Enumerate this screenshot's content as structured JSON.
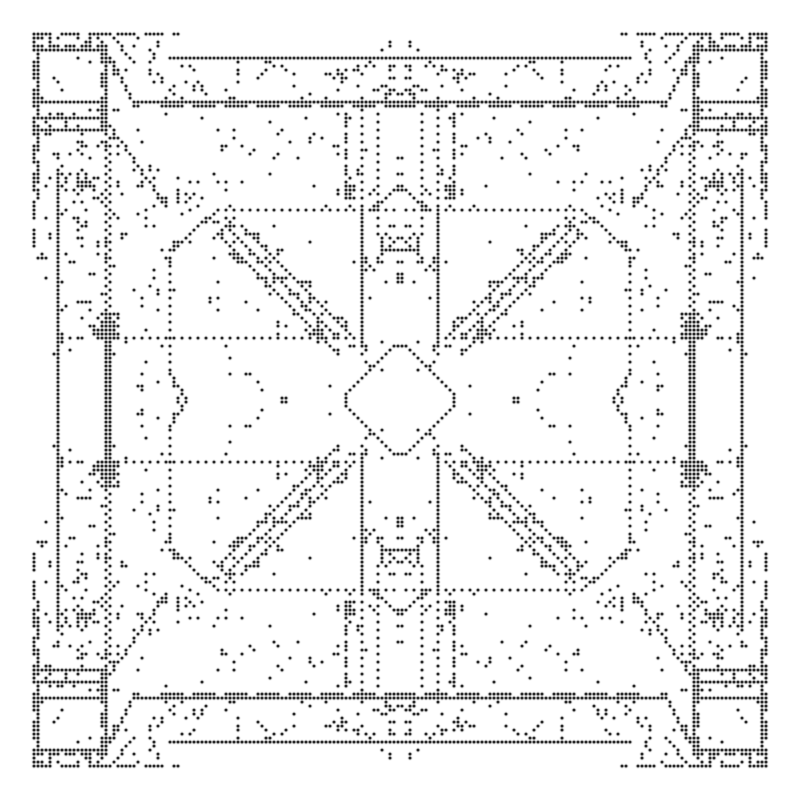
{
  "pattern": {
    "description": "Symmetric black dot-matrix ornamental pattern on white background",
    "canvas_size": 800,
    "grid": 200,
    "pitch": 4,
    "dot_radius": 1.55,
    "dot_color": "#000000",
    "background_color": "#ffffff",
    "symmetry": "mirror-horizontal-and-vertical",
    "seed": 1337,
    "quadrant_features": [
      {
        "type": "hline",
        "y": 8,
        "x0": 8,
        "x1": 44,
        "dash": [
          5,
          2
        ]
      },
      {
        "type": "vline",
        "x": 8,
        "y0": 8,
        "y1": 62,
        "dash": [
          5,
          2
        ]
      },
      {
        "type": "hline",
        "y": 11,
        "x0": 8,
        "x1": 26,
        "dash": [
          3,
          1
        ]
      },
      {
        "type": "cluster",
        "x0": 9,
        "y0": 9,
        "x1": 25,
        "y1": 10,
        "density": 0.4,
        "patch": 0.8
      },
      {
        "type": "hline",
        "y": 12,
        "x0": 9,
        "x1": 26,
        "dash": [
          1,
          0
        ]
      },
      {
        "type": "vline",
        "x": 9,
        "y0": 12,
        "y1": 29,
        "dash": [
          1,
          0
        ]
      },
      {
        "type": "vline",
        "x": 25,
        "y0": 12,
        "y1": 32,
        "dash": [
          4,
          2
        ]
      },
      {
        "type": "vline",
        "x": 26,
        "y0": 12,
        "y1": 32,
        "dash": [
          1,
          0
        ]
      },
      {
        "type": "hline",
        "y": 29,
        "x0": 8,
        "x1": 26,
        "dash": [
          1,
          0
        ]
      },
      {
        "type": "hline",
        "y": 25,
        "x0": 9,
        "x1": 25,
        "dash": [
          1,
          0
        ]
      },
      {
        "type": "hline",
        "y": 32,
        "x0": 8,
        "x1": 26,
        "dash": [
          1,
          0
        ]
      },
      {
        "type": "cluster",
        "x0": 10,
        "y0": 13,
        "x1": 24,
        "y1": 24,
        "density": 0.07,
        "patch": 0.6
      },
      {
        "type": "cluster",
        "x0": 9,
        "y0": 26,
        "x1": 25,
        "y1": 31,
        "density": 0.22,
        "patch": 0.7
      },
      {
        "type": "vline",
        "x": 9,
        "y0": 33,
        "y1": 49,
        "dash": [
          5,
          2
        ]
      },
      {
        "type": "cluster",
        "x0": 9,
        "y0": 33,
        "x1": 30,
        "y1": 48,
        "density": 0.17,
        "patch": 0.5
      },
      {
        "type": "cluster",
        "x0": 28,
        "y0": 9,
        "x1": 40,
        "y1": 27,
        "density": 0.15,
        "patch": 0.5
      },
      {
        "type": "line",
        "x0": 27,
        "y0": 8,
        "x1": 33,
        "y1": 15
      },
      {
        "type": "line",
        "x0": 24,
        "y0": 9,
        "x1": 33,
        "y1": 25
      },
      {
        "type": "hline",
        "y": 14,
        "x0": 42,
        "x1": 99,
        "dash": [
          1,
          0
        ]
      },
      {
        "type": "hline",
        "y": 25,
        "x0": 33,
        "x1": 99,
        "dash": [
          1,
          0
        ]
      },
      {
        "type": "hline",
        "y": 26,
        "x0": 40,
        "x1": 99,
        "dash": [
          6,
          2
        ]
      },
      {
        "type": "cluster",
        "x0": 33,
        "y0": 15,
        "x1": 99,
        "y1": 24,
        "density": 0.22,
        "patch": 0.45
      },
      {
        "type": "vline",
        "x": 86,
        "y0": 29,
        "y1": 46,
        "dash": [
          3,
          1
        ]
      },
      {
        "type": "cluster",
        "x0": 84,
        "y0": 46,
        "x1": 88,
        "y1": 49,
        "density": 0.5,
        "patch": 1
      },
      {
        "type": "cluster",
        "x0": 78,
        "y0": 28,
        "x1": 99,
        "y1": 51,
        "density": 0.15,
        "patch": 0.45
      },
      {
        "type": "cluster",
        "x0": 52,
        "y0": 28,
        "x1": 78,
        "y1": 45,
        "density": 0.12,
        "patch": 0.4
      },
      {
        "type": "vline",
        "x": 14,
        "y0": 42,
        "y1": 99,
        "dash": [
          1,
          0
        ]
      },
      {
        "type": "vline",
        "x": 26,
        "y0": 33,
        "y1": 78,
        "dash": [
          1,
          1
        ]
      },
      {
        "type": "vline",
        "x": 27,
        "y0": 34,
        "y1": 78,
        "dash": [
          1,
          1
        ]
      },
      {
        "type": "vline",
        "x": 26,
        "y0": 79,
        "y1": 99,
        "dash": [
          1,
          0
        ]
      },
      {
        "type": "vline",
        "x": 27,
        "y0": 79,
        "y1": 99,
        "dash": [
          1,
          0
        ]
      },
      {
        "type": "cluster",
        "x0": 24,
        "y0": 78,
        "x1": 29,
        "y1": 84,
        "density": 0.75,
        "patch": 1
      },
      {
        "type": "cluster",
        "x0": 15,
        "y0": 28,
        "x1": 26,
        "y1": 85,
        "density": 0.2,
        "patch": 0.45
      },
      {
        "type": "cluster",
        "x0": 9,
        "y0": 50,
        "x1": 14,
        "y1": 70,
        "density": 0.18,
        "patch": 0.5
      },
      {
        "type": "line",
        "x0": 25,
        "y0": 28,
        "x1": 41,
        "y1": 51
      },
      {
        "type": "cluster",
        "x0": 28,
        "y0": 28,
        "x1": 42,
        "y1": 59,
        "density": 0.12,
        "patch": 0.4
      },
      {
        "type": "hline",
        "y": 52,
        "x0": 54,
        "x1": 99,
        "dash": [
          1,
          1
        ]
      },
      {
        "type": "vline",
        "x": 42,
        "y0": 62,
        "y1": 92,
        "dash": [
          1,
          1
        ]
      },
      {
        "type": "line",
        "x0": 42,
        "y0": 62,
        "x1": 54,
        "y1": 52
      },
      {
        "type": "line",
        "x0": 42,
        "y0": 93,
        "x1": 46,
        "y1": 99
      },
      {
        "type": "line",
        "x0": 93,
        "y0": 52,
        "x1": 99,
        "y1": 46
      },
      {
        "type": "cluster",
        "x0": 28,
        "y0": 60,
        "x1": 44,
        "y1": 99,
        "density": 0.13,
        "patch": 0.4
      },
      {
        "type": "vline",
        "x": 90,
        "y0": 27,
        "y1": 50,
        "dash": [
          1,
          1
        ]
      },
      {
        "type": "vline",
        "x": 90,
        "y0": 51,
        "y1": 84,
        "dash": [
          1,
          0
        ]
      },
      {
        "type": "vline",
        "x": 94,
        "y0": 28,
        "y1": 58,
        "dash": [
          1,
          1
        ]
      },
      {
        "type": "hline",
        "y": 84,
        "x0": 27,
        "x1": 84,
        "dash": [
          1,
          1
        ]
      },
      {
        "type": "hline",
        "y": 84,
        "x0": 14,
        "x1": 26,
        "dash": [
          2,
          3
        ]
      },
      {
        "type": "line",
        "x0": 86,
        "y0": 98,
        "x1": 98,
        "y1": 86
      },
      {
        "type": "hline",
        "y": 86,
        "x0": 98,
        "x1": 99,
        "dash": [
          1,
          0
        ]
      },
      {
        "type": "vline",
        "x": 86,
        "y0": 98,
        "y1": 99,
        "dash": [
          1,
          0
        ]
      },
      {
        "type": "line",
        "x0": 56,
        "y0": 56,
        "x1": 84,
        "y1": 84
      },
      {
        "type": "line",
        "x0": 60,
        "y0": 56,
        "x1": 88,
        "y1": 84
      },
      {
        "type": "line",
        "x0": 56,
        "y0": 60,
        "x1": 84,
        "y1": 88
      },
      {
        "type": "line",
        "x0": 94,
        "y0": 64,
        "x1": 99,
        "y1": 59
      },
      {
        "type": "cluster",
        "x0": 91,
        "y0": 56,
        "x1": 99,
        "y1": 70,
        "density": 0.26,
        "patch": 0.55
      },
      {
        "type": "dband",
        "x0": 44,
        "y0": 44,
        "x1": 92,
        "y1": 92,
        "band": 6,
        "density": 0.26,
        "patch": 0.5
      },
      {
        "type": "cluster",
        "x0": 43,
        "y0": 53,
        "x1": 99,
        "y1": 99,
        "density": 0.04,
        "patch": 0.3
      },
      {
        "type": "cluster",
        "x0": 95,
        "y0": 8,
        "x1": 99,
        "y1": 13,
        "density": 0.3,
        "patch": 0.7
      },
      {
        "type": "cluster",
        "x0": 6,
        "y0": 6,
        "x1": 99,
        "y1": 99,
        "density": 0.012,
        "patch": 0.25
      }
    ]
  }
}
